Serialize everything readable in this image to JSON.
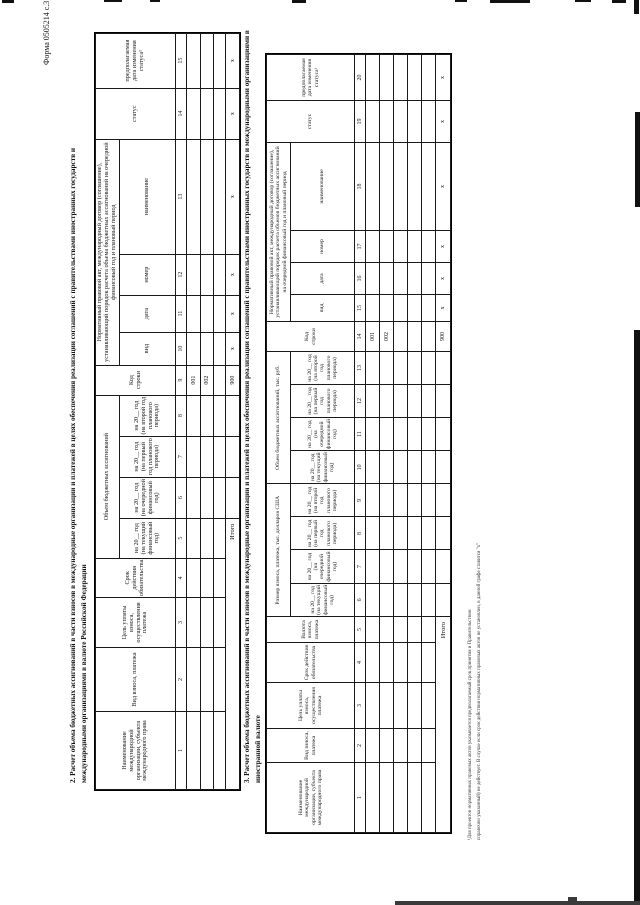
{
  "page": {
    "form_label": "Форма 0505214 с.3"
  },
  "section2": {
    "heading_line1": "2. Расчет объема бюджетных ассигнований в части взносов в международные организации и платежей в целях обеспечения реализации соглашений с правительствами иностранных государств и",
    "heading_line2": "международными организациями в валюте Российской Федерации",
    "table": {
      "h1": 24,
      "h2": 56,
      "hn": 11,
      "row_heights": [
        14,
        13,
        12
      ],
      "total_height": 14,
      "total_label": "Итого",
      "total_span": 5,
      "groups": [
        {
          "label": null,
          "cols": [
            {
              "num": "1",
              "title": "Наименование международной организации, субъекта международного права",
              "w": 78
            },
            {
              "num": "2",
              "title": "Вид взноса, платежа",
              "w": 64
            },
            {
              "num": "3",
              "title": "Цель уплаты взноса, осуществления платежа",
              "w": 50
            },
            {
              "num": "4",
              "title": "Срок действия обязательства",
              "w": 38
            }
          ]
        },
        {
          "label": "Объем бюджетных ассигнований",
          "cols": [
            {
              "num": "5",
              "title": "на 20__ год (на текущий финансовый год)",
              "w": 40,
              "total": ""
            },
            {
              "num": "6",
              "title": "на 20__ год (на очередной финансовый год)",
              "w": 41,
              "total": ""
            },
            {
              "num": "7",
              "title": "на 20__ год (на первый год планового периода)",
              "w": 41,
              "total": ""
            },
            {
              "num": "8",
              "title": "на 20__ год (на второй год планового периода)",
              "w": 41,
              "total": ""
            }
          ]
        },
        {
          "label": null,
          "cols": [
            {
              "num": "9",
              "title": "Код строки",
              "w": 30,
              "code": true,
              "total": "900"
            }
          ]
        },
        {
          "label": "Нормативный правовой акт, международный договор (соглашение), устанавливающий порядок расчета объема бюджетных ассигнований на очередной финансовый год и плановый период",
          "cols": [
            {
              "num": "10",
              "title": "вид",
              "w": 33,
              "total": "х"
            },
            {
              "num": "11",
              "title": "дата",
              "w": 37,
              "total": "х"
            },
            {
              "num": "12",
              "title": "номер",
              "w": 41,
              "total": "х"
            },
            {
              "num": "13",
              "title": "наименование",
              "w": 115,
              "total": "х"
            }
          ]
        },
        {
          "label": null,
          "cols": [
            {
              "num": "14",
              "title": "статус",
              "w": 51,
              "total": "х"
            },
            {
              "num": "15",
              "title": "предполагаемая дата изменения статуса¹",
              "w": 55,
              "total": "х"
            }
          ]
        }
      ],
      "rows": [
        {
          "code": "001"
        },
        {
          "code": "002"
        },
        {
          "code": ""
        }
      ]
    }
  },
  "section3": {
    "heading_line1": "3. Расчет объема бюджетных ассигнований в части взносов в международные организации и платежей в целях обеспечения реализации соглашений с правительствами иностранных государств и международными организациями в",
    "heading_line2": "иностранной валюте",
    "table": {
      "h1": 24,
      "h2": 64,
      "hn": 11,
      "row_heights": [
        14,
        14,
        14,
        14,
        14
      ],
      "total_height": 15,
      "total_label": "Итого",
      "total_span": 5,
      "groups": [
        {
          "label": null,
          "cols": [
            {
              "num": "1",
              "title": "Наименование международной организации, субъекта международного права",
              "w": 70
            },
            {
              "num": "2",
              "title": "Вид взноса, платежа",
              "w": 34
            },
            {
              "num": "3",
              "title": "Цель уплаты взноса, осуществления платежа",
              "w": 46
            },
            {
              "num": "4",
              "title": "Срок действия обязательства",
              "w": 40
            },
            {
              "num": "5",
              "title": "Валюта взноса, платежа",
              "w": 26
            }
          ]
        },
        {
          "label": "Размер взноса, платежа, тыс. долларов США",
          "cols": [
            {
              "num": "6",
              "title": "на 20__ год (на текущий финансовый год)",
              "w": 33,
              "total": ""
            },
            {
              "num": "7",
              "title": "на 20__ год (на очередной финансовый год)",
              "w": 33,
              "total": ""
            },
            {
              "num": "8",
              "title": "на 20__ год (на первый год планового периода)",
              "w": 33,
              "total": ""
            },
            {
              "num": "9",
              "title": "на 20__ год (на второй год планового периода)",
              "w": 33,
              "total": ""
            }
          ]
        },
        {
          "label": "Объем бюджетных ассигнований, тыс. руб.",
          "cols": [
            {
              "num": "10",
              "title": "на 20__ год (на текущий финансовый год)",
              "w": 33,
              "total": ""
            },
            {
              "num": "11",
              "title": "на 20__ год (на очередной финансовый год)",
              "w": 33,
              "total": ""
            },
            {
              "num": "12",
              "title": "на 20__ год (на первый год планового периода)",
              "w": 33,
              "total": ""
            },
            {
              "num": "13",
              "title": "на 20__ год (на второй год планового периода)",
              "w": 33,
              "total": ""
            }
          ]
        },
        {
          "label": null,
          "cols": [
            {
              "num": "14",
              "title": "Код строки",
              "w": 30,
              "code": true,
              "total": "900"
            }
          ]
        },
        {
          "label": "Нормативный правовой акт, международный договор (соглашение), устанавливающий порядок расчета объемов бюджетных ассигнований на очередной финансовый год и плановый период",
          "cols": [
            {
              "num": "15",
              "title": "вид",
              "w": 27,
              "total": "х"
            },
            {
              "num": "16",
              "title": "дата",
              "w": 32,
              "total": "х"
            },
            {
              "num": "17",
              "title": "номер",
              "w": 32,
              "total": "х"
            },
            {
              "num": "18",
              "title": "наименование",
              "w": 88,
              "total": "х"
            }
          ]
        },
        {
          "label": null,
          "cols": [
            {
              "num": "19",
              "title": "статус",
              "w": 42,
              "total": "х"
            },
            {
              "num": "20",
              "title": "предполагаемая дата изменения статуса¹",
              "w": 46,
              "total": "х"
            }
          ]
        }
      ],
      "rows": [
        {
          "code": "001"
        },
        {
          "code": "002"
        },
        {
          "code": ""
        },
        {
          "code": ""
        },
        {
          "code": ""
        }
      ]
    }
  },
  "footnote": {
    "line1": "¹Для проектов нормативных правовых актов указывается предполагаемый срок принятия и Правительством",
    "line2": "справочно указанный) не действует. В случае если срок действия нормативных правовых актов не установлен, в данной графе ставится \"х\""
  }
}
